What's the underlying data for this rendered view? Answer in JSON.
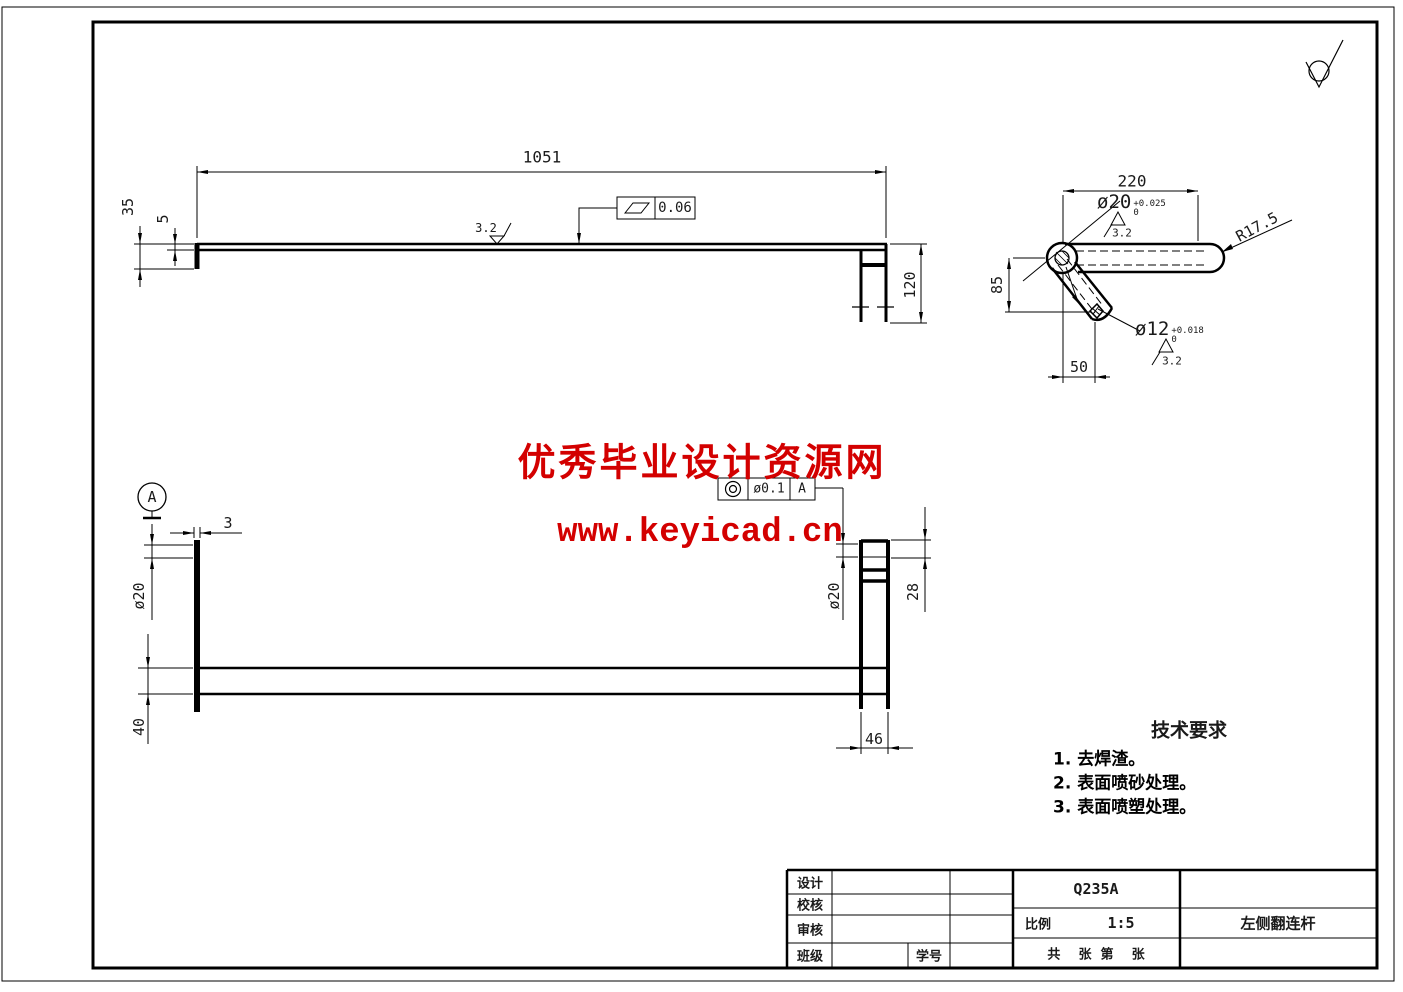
{
  "watermark": {
    "line1": "优秀毕业设计资源网",
    "line2": "www.keyicad.cn",
    "color": "#d30000"
  },
  "top_view": {
    "dim_length": "1051",
    "dim_35": "35",
    "dim_5": "5",
    "dim_120": "120",
    "flatness_value": "0.06",
    "roughness": "3.2"
  },
  "detail_view": {
    "dim_220": "220",
    "dim_85": "85",
    "dim_50": "50",
    "radius_label": "R17.5",
    "hole20": {
      "label": "ø20",
      "tol_upper": "+0.025",
      "tol_lower": "0",
      "roughness": "3.2"
    },
    "hole12": {
      "label": "ø12",
      "tol_upper": "+0.018",
      "tol_lower": "0",
      "roughness": "3.2"
    }
  },
  "bottom_view": {
    "datum_label": "A",
    "dim_3": "3",
    "dim_d20_left": "ø20",
    "dim_40": "40",
    "dim_d20_right": "ø20",
    "dim_28": "28",
    "dim_46": "46",
    "tolerance_frame": {
      "symbol": "concentricity",
      "value": "ø0.1",
      "datum": "A"
    }
  },
  "tech_requirements": {
    "title": "技术要求",
    "items": [
      "1. 去焊渣。",
      "2. 表面喷砂处理。",
      "3. 表面喷塑处理。"
    ]
  },
  "title_block": {
    "design_label": "设计",
    "check_label": "校核",
    "review_label": "审核",
    "class_label": "班级",
    "student_id_label": "学号",
    "material": "Q235A",
    "scale_label": "比例",
    "scale_value": "1:5",
    "sheet_text": "共    张  第    张",
    "part_name": "左侧翻连杆"
  }
}
